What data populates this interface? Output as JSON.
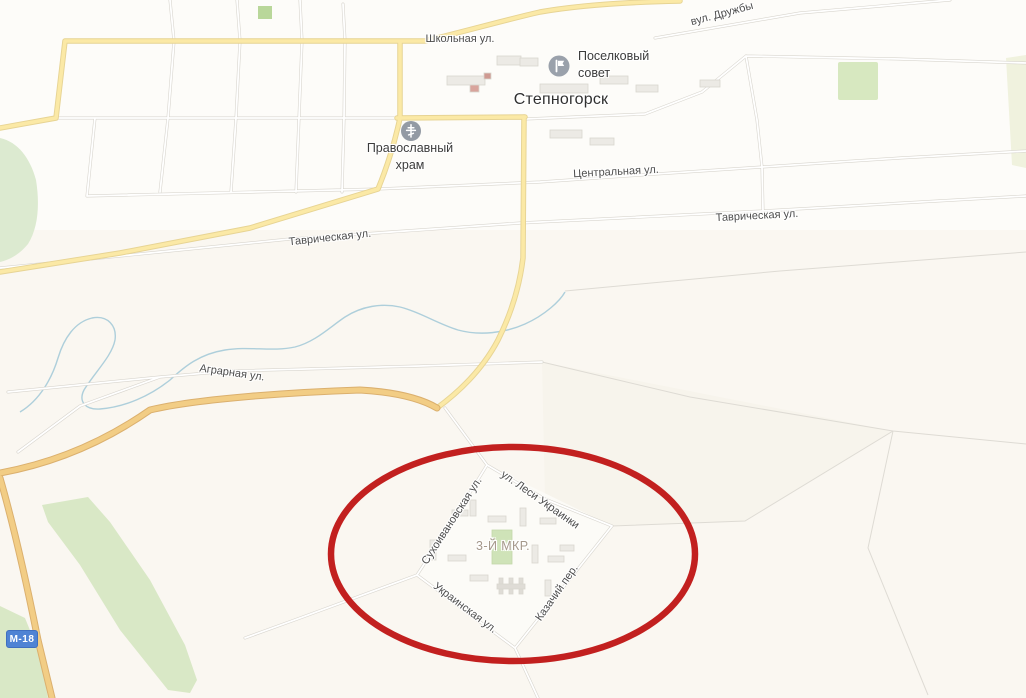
{
  "map": {
    "town_label": "Степногорск",
    "district_label": "3-Й МКР.",
    "streets": {
      "shkolnaya": "Школьная ул.",
      "druzhby": "вул. Дружбы",
      "tsentralnaya": "Центральная ул.",
      "tavricheskaya_left": "Таврическая ул.",
      "tavricheskaya_right": "Таврическая ул.",
      "agrarnaya": "Аграрная ул.",
      "lesi_ukrainki": "ул. Леси Украинки",
      "sukhoivanovskaya": "Сухоивановская ул.",
      "ukrainskaya": "Украинская ул.",
      "kazachiy": "Казачий пер."
    },
    "pois": {
      "sovet": {
        "line1": "Поселковый",
        "line2": "совет",
        "icon": "flag-icon"
      },
      "hram": {
        "line1": "Православный",
        "line2": "храм",
        "icon": "orthodox-cross-icon"
      }
    },
    "road_badge": "М-18",
    "annotation": {
      "shape": "ellipse",
      "color": "#c2201f"
    },
    "colors": {
      "background": "#fcfbf7",
      "field_tint": "#faf7f1",
      "green_area": "#dcead0",
      "town_road_yellow": "#fbe9a6",
      "highway_orange": "#f2cd85",
      "minor_road": "#ffffff",
      "water_blue": "#aecfdb",
      "badge_blue": "#4f83d4",
      "street_label": "#4d4d4d",
      "district_label_color": "#a5988b"
    }
  }
}
